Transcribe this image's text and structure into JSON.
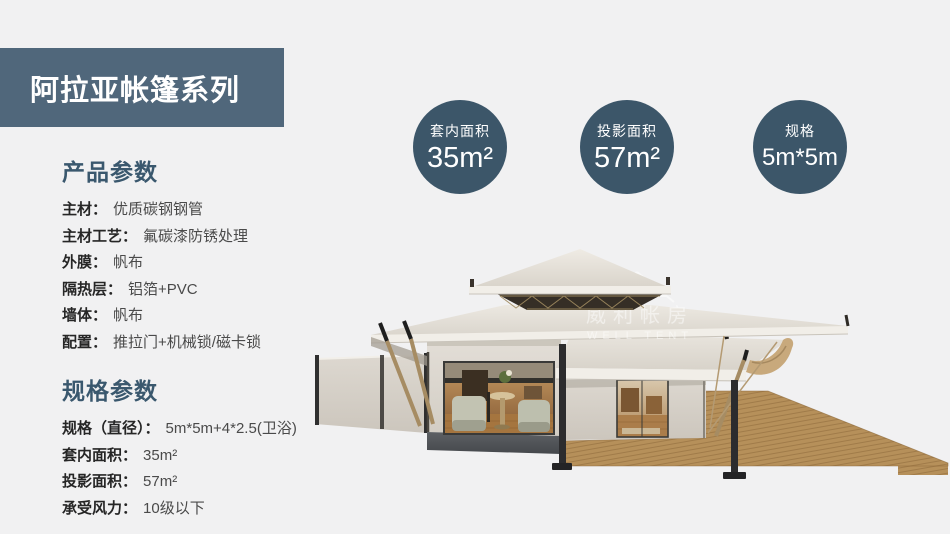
{
  "theme": {
    "background": "#f1f1f2",
    "banner_bg": "#50677b",
    "badge_bg": "#3c5669",
    "heading_color": "#3a586e",
    "label_color": "#262626",
    "value_color": "#4a4a4a",
    "roof_canvas": "#e0dbd3",
    "deck_wood": "#b6905a",
    "stone_base": "#53565a"
  },
  "banner": {
    "title": "阿拉亚帐篷系列"
  },
  "badges": [
    {
      "label": "套内面积",
      "value": "35m²"
    },
    {
      "label": "投影面积",
      "value": "57m²"
    },
    {
      "label": "规格",
      "value": "5m*5m"
    }
  ],
  "sections": [
    {
      "heading": "产品参数",
      "items": [
        {
          "label": "主材：",
          "value": "优质碳钢钢管"
        },
        {
          "label": "主材工艺：",
          "value": "氟碳漆防锈处理"
        },
        {
          "label": "外膜：",
          "value": "帆布"
        },
        {
          "label": "隔热层：",
          "value": "铝箔+PVC"
        },
        {
          "label": "墙体：",
          "value": "帆布"
        },
        {
          "label": "配置：",
          "value": "推拉门+机械锁/磁卡锁"
        }
      ]
    },
    {
      "heading": "规格参数",
      "items": [
        {
          "label": "规格（直径）：",
          "value": "5m*5m+4*2.5(卫浴)"
        },
        {
          "label": "套内面积：",
          "value": "35m²"
        },
        {
          "label": "投影面积：",
          "value": "57m²"
        },
        {
          "label": "承受风力：",
          "value": "10级以下"
        }
      ]
    }
  ],
  "illustration": {
    "description": "luxury glamping tent render with two-tier pyramid roof, glass lounge wall, side awning and wooden deck",
    "watermark_cn": "威利帐房",
    "watermark_en": "WELL TENT"
  }
}
